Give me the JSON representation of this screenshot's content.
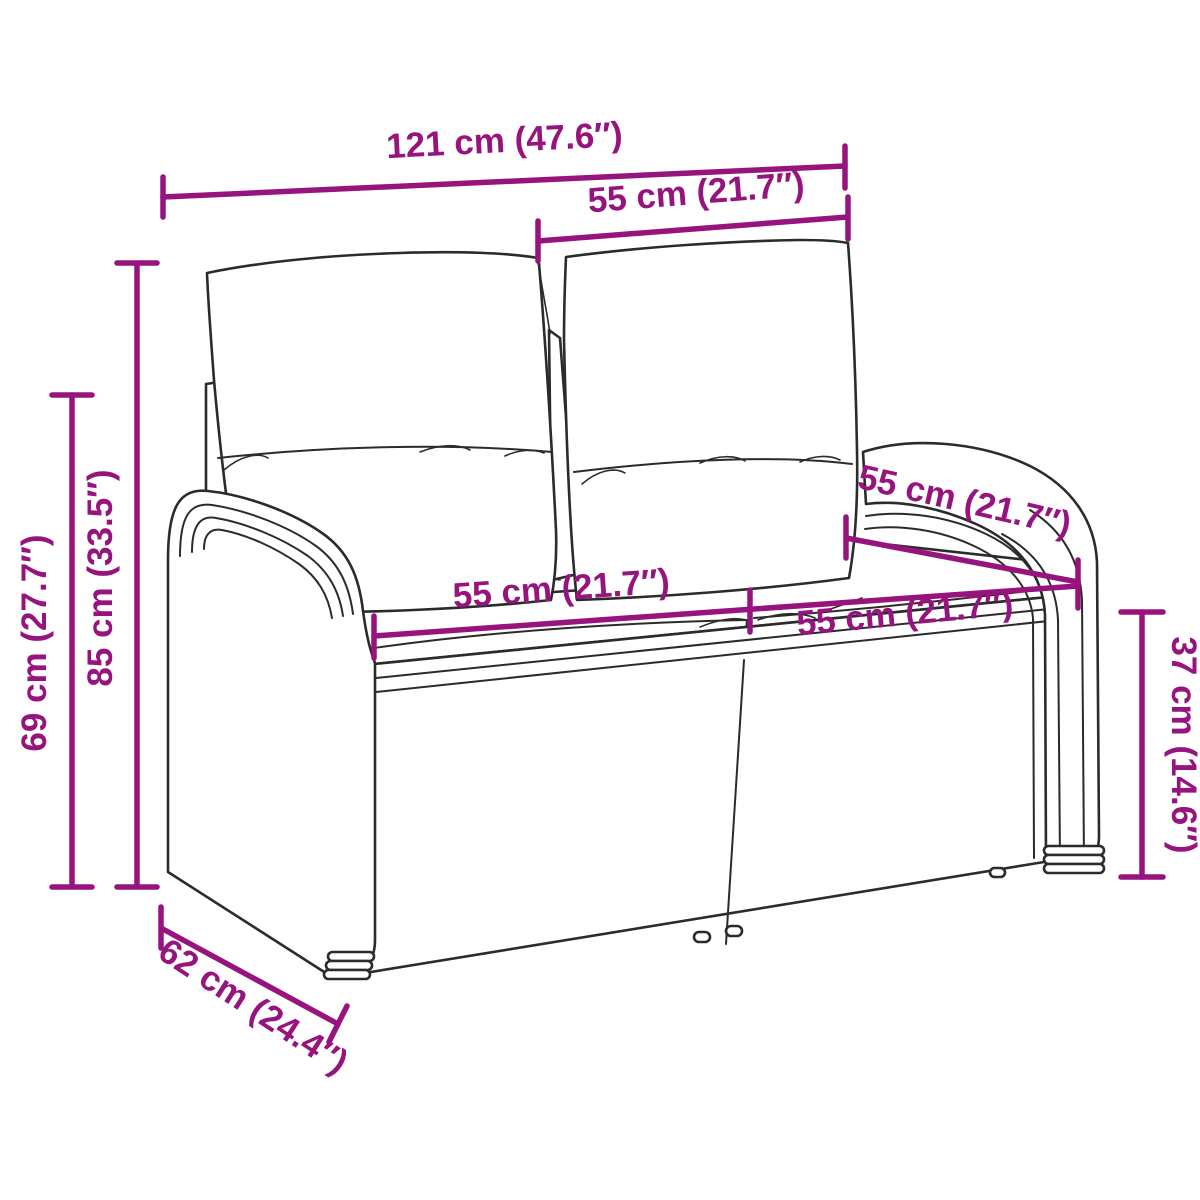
{
  "colors": {
    "dimension_accent": "#97137D",
    "line_art": "#2B2B2B",
    "background": "#FFFFFF"
  },
  "dimensions": {
    "width_total": {
      "label": "121 cm (47.6″)"
    },
    "backrest_section_width": {
      "label": "55 cm (21.7″)"
    },
    "height_total": {
      "label": "85 cm (33.5″)"
    },
    "armrest_height": {
      "label": "69 cm (27.7″)"
    },
    "seat_depth": {
      "label": "55 cm (21.7″)"
    },
    "seat_width_left": {
      "label": "55 cm (21.7″)"
    },
    "seat_width_right": {
      "label": "55 cm (21.7″)"
    },
    "seat_height": {
      "label": "37 cm (14.6″)"
    },
    "depth_total": {
      "label": "62 cm (24.4″)"
    }
  }
}
